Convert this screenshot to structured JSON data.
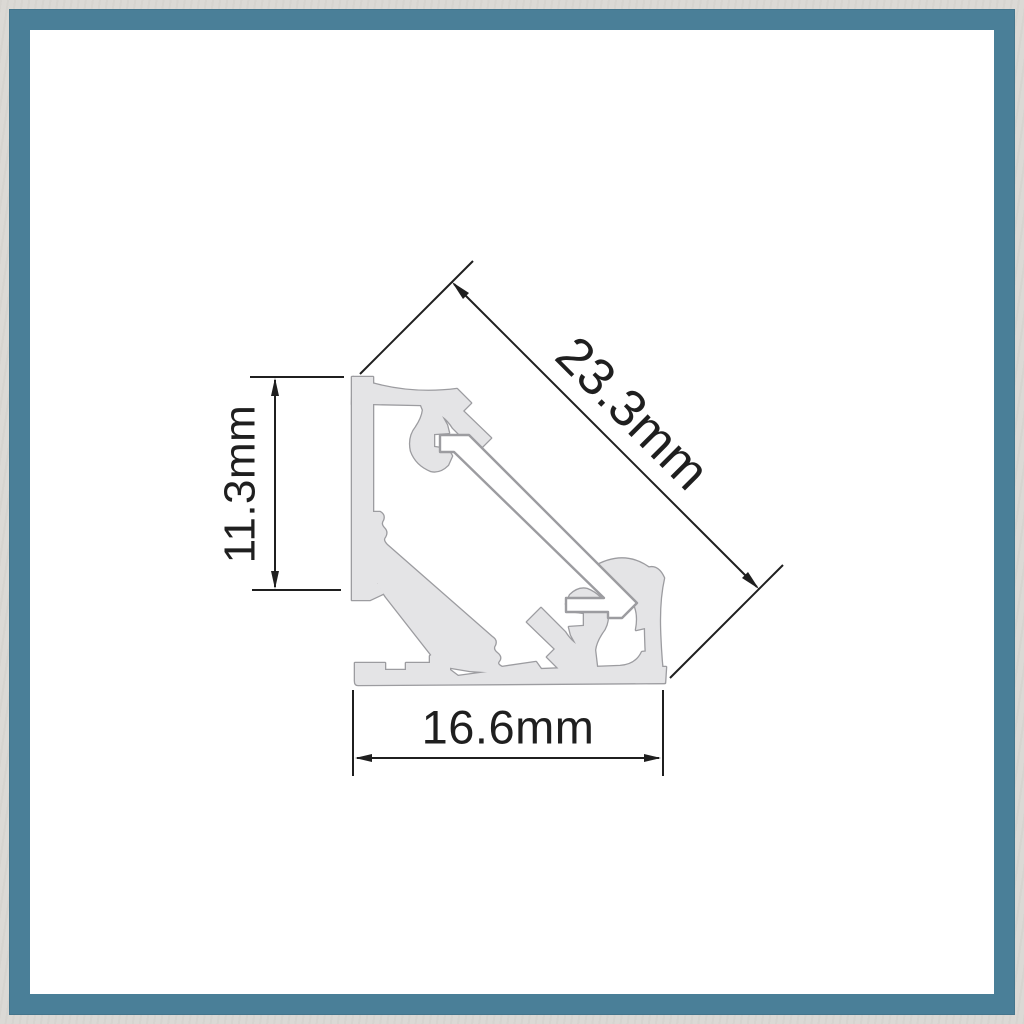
{
  "frame": {
    "marble_color": "#dbd9d5",
    "teal_color": "#4a7f98",
    "canvas_color": "#ffffff"
  },
  "diagram": {
    "labels": {
      "diagonal": "23.3mm",
      "height": "11.3mm",
      "width": "16.6mm"
    },
    "colors": {
      "profile_fill": "#e4e4e6",
      "profile_outline": "#9c9ca0",
      "dimension_ink": "#1f1f1f"
    }
  }
}
